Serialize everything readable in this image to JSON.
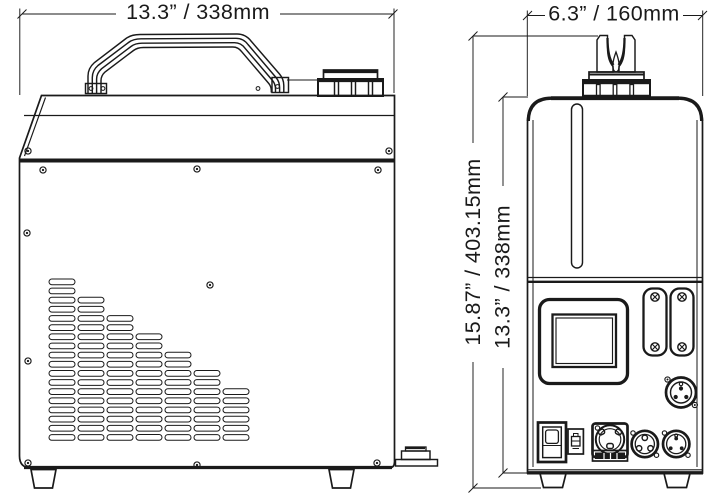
{
  "drawing": {
    "background": "#ffffff",
    "line_color": "#1a1a1a",
    "labels": {
      "side_width": "13.3” / 338mm",
      "rear_width": "6.3” / 160mm",
      "total_height": "15.87” / 403.15mm",
      "body_height": "13.3” / 338mm"
    },
    "side_view": {
      "vent_columns": [
        18,
        16,
        14,
        12,
        10,
        8,
        6
      ],
      "screw_count": 11,
      "components": [
        "carry-handle",
        "fluid-tank-cap",
        "vent-grille",
        "rubber-feet",
        "mounting-bracket"
      ]
    },
    "rear_view": {
      "plate_screw_count": 4,
      "components": [
        "output-nozzle",
        "tank-cap",
        "sight-tube",
        "display-window",
        "cover-plates",
        "xlr-connector",
        "power-rocker-switch",
        "fuse-holder",
        "powercon-inlet",
        "dmx-female-connector",
        "dmx-male-connector",
        "rubber-feet"
      ]
    }
  }
}
